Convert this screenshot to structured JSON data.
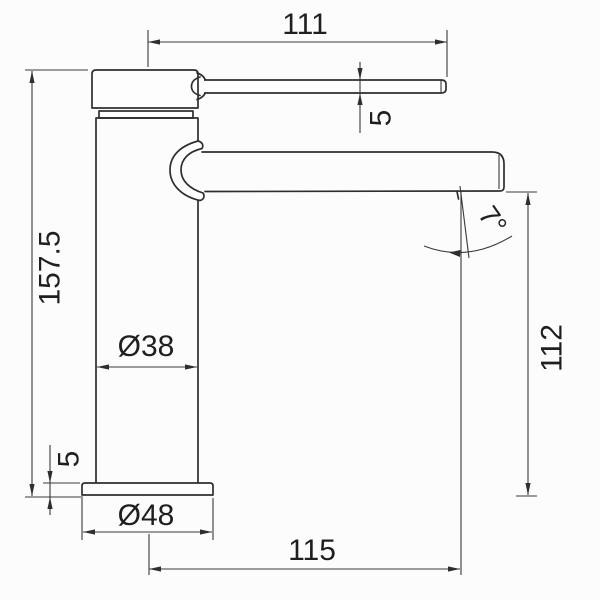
{
  "drawing": {
    "kind": "faucet-dimension-drawing",
    "colors": {
      "background": "#fcfcfc",
      "line": "#2e2e2e",
      "text": "#1f1f1f"
    },
    "dims": {
      "lever_length": "111",
      "lever_thickness": "5",
      "total_height": "157.5",
      "body_diameter": "Ø38",
      "outlet_height": "112",
      "base_thickness": "5",
      "base_diameter": "Ø48",
      "spout_reach": "115",
      "outlet_angle": "7°"
    }
  }
}
